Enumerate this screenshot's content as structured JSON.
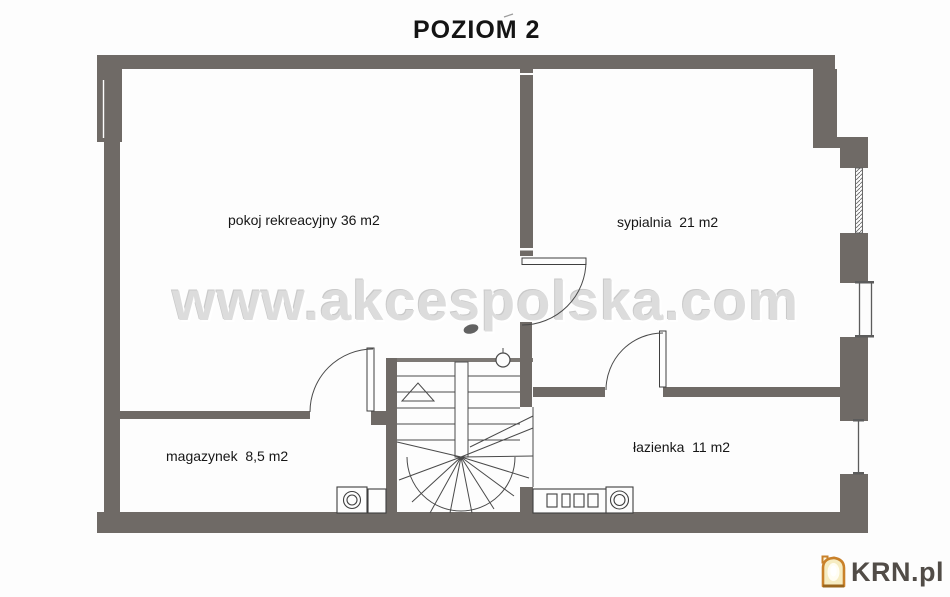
{
  "title": "POZIOM 2",
  "watermark": "www.akcespolska.com",
  "rooms": {
    "recreation": "pokoj rekreacyjny 36 m2",
    "bedroom": "sypialnia  21 m2",
    "storage": "magazynek  8,5 m2",
    "bathroom": "łazienka  11 m2"
  },
  "logo": {
    "text": "KRN.pl"
  },
  "colors": {
    "wall": "#6f6a66",
    "background": "#fdfdfd",
    "thin_line": "#454545",
    "watermark": "#dcdcdc",
    "logo_orange": "#c9812a",
    "logo_text": "#514c47"
  }
}
